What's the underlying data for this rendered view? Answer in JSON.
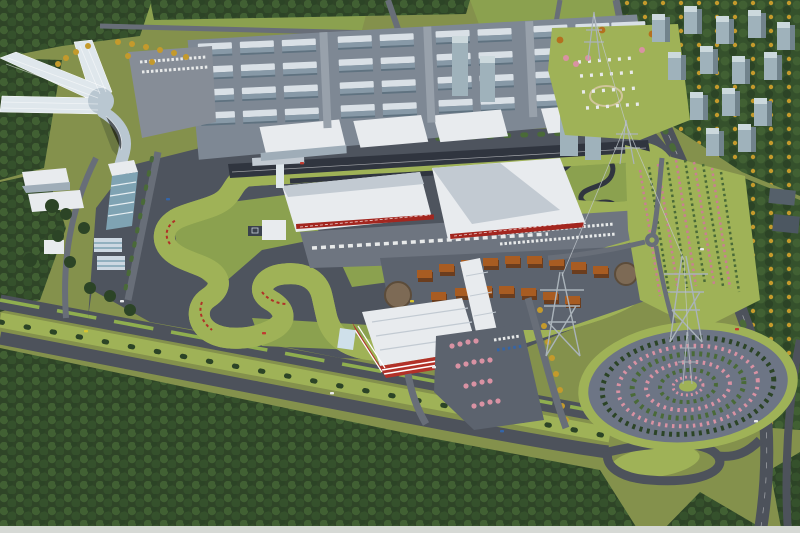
{
  "meta": {
    "title": "Aerial masterplan rendering of a motorsport circuit with industrial park, paddock village, parking garage, circular tree garden and surrounding forests",
    "type": "architectural-aerial-rendering",
    "width_px": 800,
    "height_px": 533
  },
  "scene": {
    "regions": [
      "star-shaped-glass-exhibition-building",
      "industrial-park-building-grid",
      "race-circuit-main-straight",
      "pit-and-grandstand-buildings",
      "control-tower",
      "winding-race-track",
      "kart-track",
      "paddock-village-orange-roofs",
      "multi-storey-parking-garage",
      "circular-tree-garden",
      "flower-nursery-rows",
      "high-rise-residential-cluster",
      "power-transmission-line",
      "boulevard-with-green-median",
      "perimeter-forest"
    ]
  },
  "palette": {
    "field": "#84914c",
    "lawn": "#9fb257",
    "lawn2": "#8ba14f",
    "forest_base": "#2f4527",
    "forest_hi": "#416033",
    "forest_mid": "#35512c",
    "tree_dark": "#2c4426",
    "tree_mid": "#4a6a38",
    "autumn": "#c49a2c",
    "autumn2": "#b4701f",
    "pink": "#d992a3",
    "pink2": "#c97f93",
    "venue": "#4e545e",
    "venue2": "#5c636e",
    "apron": "#6e7580",
    "plaza": "#868d97",
    "track": "#30353f",
    "road": "#4d525b",
    "road_light": "#686e78",
    "median": "#8fae4f",
    "roof_white": "#e8ebee",
    "roof_shade": "#c2cad2",
    "banner_red": "#a3261f",
    "curb_red": "#b03128",
    "ind_roof": "#d9e0e6",
    "ind_face": "#8799a7",
    "ind_side": "#5f7280",
    "hall_face": "#9fadb8",
    "glass": "#b9c7d1",
    "glass_hi": "#dfe7ec",
    "teal_glass": "#7fa3b3",
    "orange_roof": "#a85c22",
    "orange_dark": "#6b3d1e",
    "garage_red": "#b23129",
    "garden_pav": "#6d7585",
    "wire": "#c2c8cd",
    "tower_steel": "#aab3ba",
    "highrise_face": "#9fb2bb",
    "highrise_top": "#ccd9dd",
    "highrise_side": "#71838c",
    "car_red": "#c03b30",
    "car_blue": "#3465a8",
    "car_yellow": "#d8c62f",
    "car_white": "#e8eaea",
    "strip": "#d6d9d5"
  }
}
